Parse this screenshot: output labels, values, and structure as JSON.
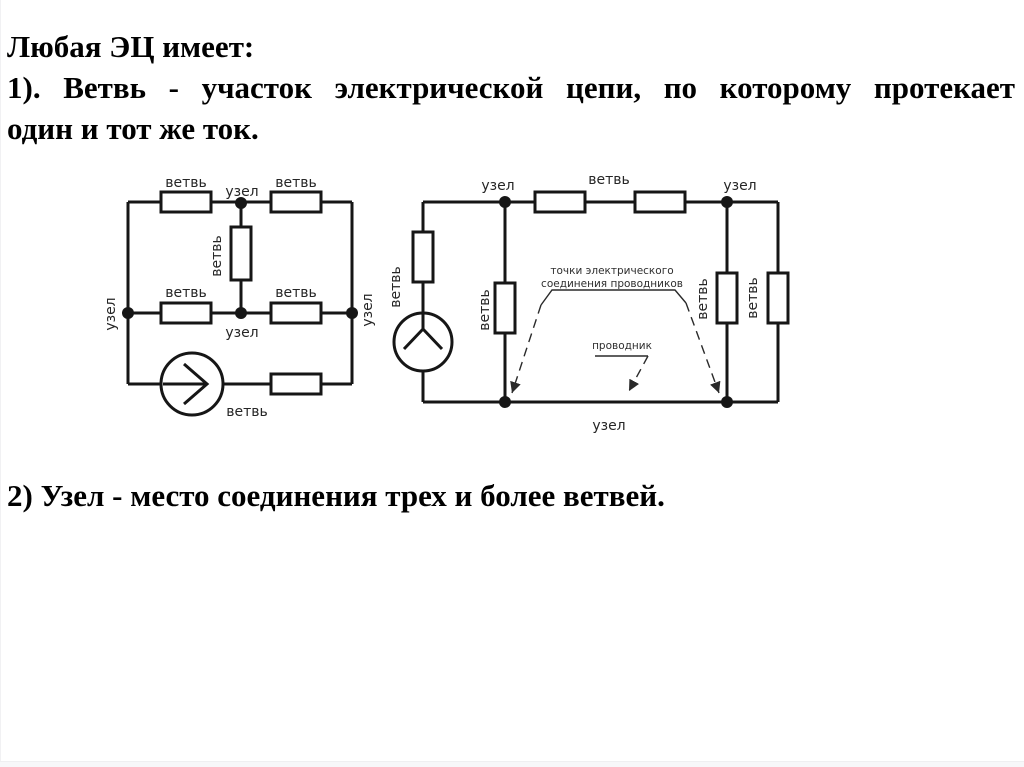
{
  "slide": {
    "heading": "Любая ЭЦ имеет:",
    "definition_branch_line1": "1). Ветвь - участок электрической цепи, по которому протекает",
    "definition_branch_line2": "один и тот же ток.",
    "definition_node": "2) Узел - место соединения трех и более ветвей."
  },
  "diagram": {
    "branch_label": "ветвь",
    "node_label": "узел",
    "connection_points_line1": "точки электрического",
    "connection_points_line2": "соединения проводников",
    "conductor_label": "проводник"
  },
  "colors": {
    "background": "#ffffff",
    "text": "#000000",
    "line": "#161616",
    "label": "#262626"
  }
}
